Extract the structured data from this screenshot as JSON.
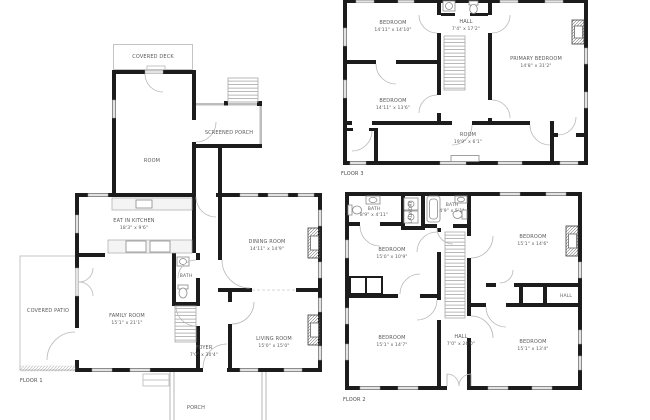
{
  "colors": {
    "wall": "#1c1c1c",
    "light_wall": "#bdbdbd",
    "window": "#e3e3e3",
    "label_text": "#5a5a5a",
    "background": "#ffffff"
  },
  "floor1": {
    "tag": "FLOOR 1",
    "rooms": {
      "covered_deck": {
        "name": "COVERED DECK",
        "dims": ""
      },
      "room": {
        "name": "ROOM",
        "dims": ""
      },
      "screened_porch": {
        "name": "SCREENED PORCH",
        "dims": ""
      },
      "eat_in_kitchen": {
        "name": "EAT IN KITCHEN",
        "dims": "18'3\" x 9'6\""
      },
      "dining_room": {
        "name": "DINING ROOM",
        "dims": "14'11\" x 14'9\""
      },
      "bath": {
        "name": "BATH",
        "dims": ""
      },
      "covered_patio": {
        "name": "COVERED PATIO",
        "dims": ""
      },
      "family_room": {
        "name": "FAMILY ROOM",
        "dims": "15'1\" x 21'1\""
      },
      "foyer": {
        "name": "FOYER",
        "dims": "7'0\" x 30'4\""
      },
      "living_room": {
        "name": "LIVING ROOM",
        "dims": "15'0\" x 15'0\""
      },
      "porch": {
        "name": "PORCH",
        "dims": ""
      }
    }
  },
  "floor2": {
    "tag": "FLOOR 2",
    "rooms": {
      "bath_left": {
        "name": "BATH",
        "dims": "8'9\" x 4'11\""
      },
      "laundry": {
        "name": "LAUNDRY",
        "dims": ""
      },
      "bath_mid": {
        "name": "BATH",
        "dims": "4'9\" x 5'1\""
      },
      "bedroom_left": {
        "name": "BEDROOM",
        "dims": "15'0\" x 10'9\""
      },
      "bedroom_right_top": {
        "name": "BEDROOM",
        "dims": "15'1\" x 14'6\""
      },
      "hall_small": {
        "name": "HALL",
        "dims": ""
      },
      "bedroom_bottom_left": {
        "name": "BEDROOM",
        "dims": "15'1\" x 14'7\""
      },
      "hall": {
        "name": "HALL",
        "dims": "7'0\" x 26'0\""
      },
      "bedroom_bottom_right": {
        "name": "BEDROOM",
        "dims": "15'1\" x 13'4\""
      }
    }
  },
  "floor3": {
    "tag": "FLOOR 3",
    "rooms": {
      "bedroom_top": {
        "name": "BEDROOM",
        "dims": "14'11\" x 14'10\""
      },
      "hall": {
        "name": "HALL",
        "dims": "7'4\" x 17'2\""
      },
      "primary_bedroom": {
        "name": "PRIMARY BEDROOM",
        "dims": "14'8\" x 31'2\""
      },
      "bedroom_lower": {
        "name": "BEDROOM",
        "dims": "14'11\" x 13'6\""
      },
      "room": {
        "name": "ROOM",
        "dims": "19'9\" x 6'1\""
      }
    }
  }
}
